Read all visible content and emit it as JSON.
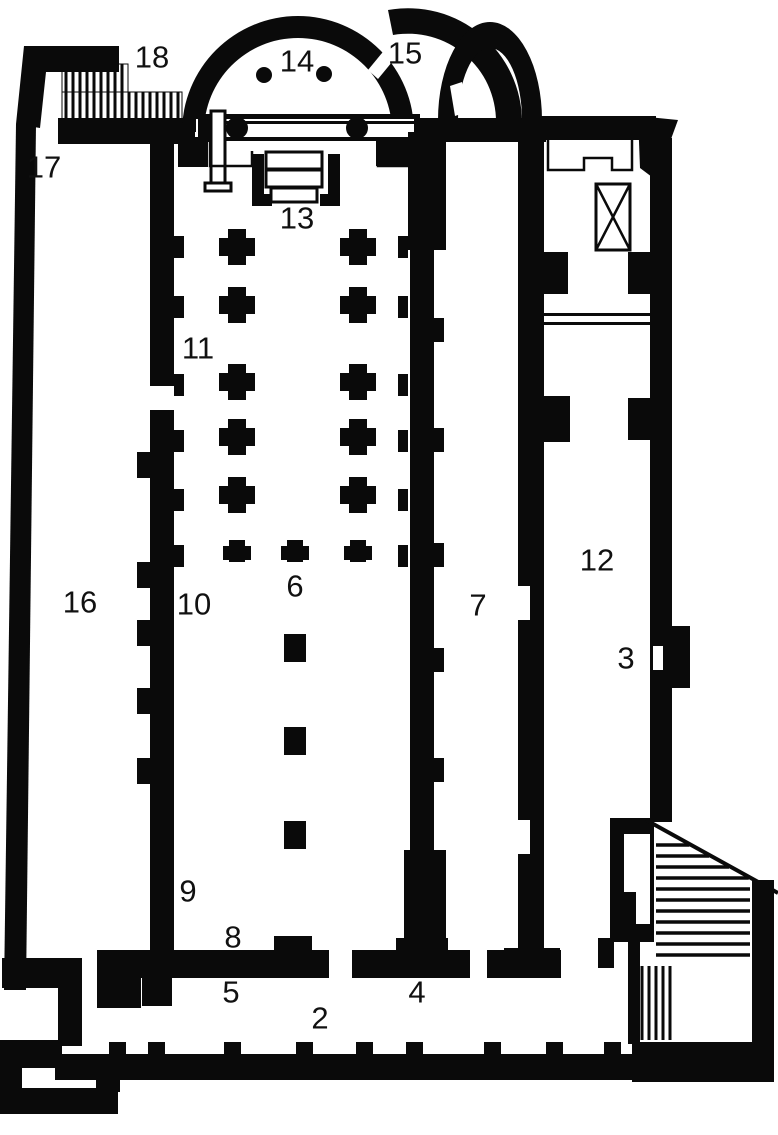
{
  "figure": {
    "kind": "architectural-floor-plan",
    "ink_color": "#0a0a0a",
    "paper_color": "#ffffff",
    "labels": [
      {
        "text": "2",
        "x": 320,
        "y": 1018
      },
      {
        "text": "3",
        "x": 626,
        "y": 658
      },
      {
        "text": "4",
        "x": 417,
        "y": 992
      },
      {
        "text": "5",
        "x": 231,
        "y": 992
      },
      {
        "text": "6",
        "x": 295,
        "y": 586
      },
      {
        "text": "7",
        "x": 478,
        "y": 605
      },
      {
        "text": "8",
        "x": 233,
        "y": 937
      },
      {
        "text": "9",
        "x": 188,
        "y": 891
      },
      {
        "text": "10",
        "x": 194,
        "y": 604
      },
      {
        "text": "11",
        "x": 198,
        "y": 348
      },
      {
        "text": "12",
        "x": 597,
        "y": 560
      },
      {
        "text": "13",
        "x": 297,
        "y": 218
      },
      {
        "text": "14",
        "x": 297,
        "y": 61
      },
      {
        "text": "15",
        "x": 405,
        "y": 53
      },
      {
        "text": "16",
        "x": 80,
        "y": 602
      },
      {
        "text": "17",
        "x": 44,
        "y": 167
      },
      {
        "text": "18",
        "x": 152,
        "y": 57
      }
    ]
  }
}
